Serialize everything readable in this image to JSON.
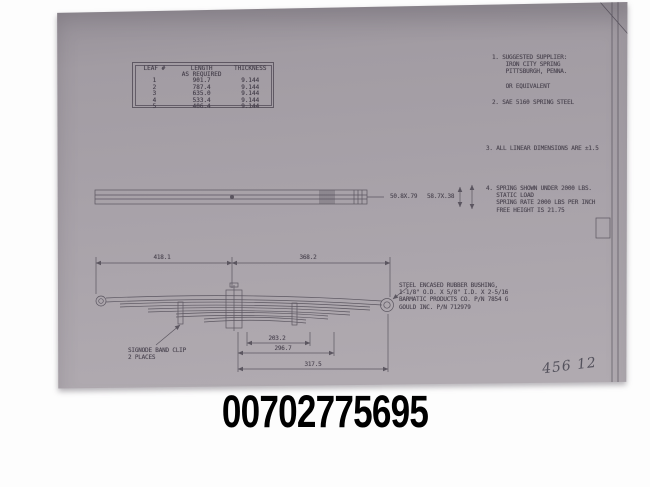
{
  "part_number": "00702775695",
  "colors": {
    "paper": "#a49ea5",
    "paper_shadow": "#938d95",
    "line_ink": "#4a4550",
    "page_background": "#fdfdfd",
    "number_ink": "#000000"
  },
  "drawing": {
    "leaf_table": {
      "headers": [
        "LEAF #",
        "LENGTH\nAS REQUIRED",
        "THICKNESS"
      ],
      "rows": [
        [
          "1",
          "901.7",
          "9.144"
        ],
        [
          "2",
          "787.4",
          "9.144"
        ],
        [
          "3",
          "635.0",
          "9.144"
        ],
        [
          "4",
          "533.4",
          "9.144"
        ],
        [
          "5",
          "406.4",
          "9.144"
        ]
      ]
    },
    "notes": [
      "1. SUGGESTED SUPPLIER:\n    IRON CITY SPRING\n    PITTSBURGH, PENNA.\n\n    OR EQUIVALENT",
      "2. SAE 5160 SPRING STEEL",
      "3. ALL LINEAR DIMENSIONS ARE ±1.5",
      "4. SPRING SHOWN UNDER 2000 LBS.\n   STATIC LOAD\n   SPRING RATE 2000 LBS PER INCH\n   FREE HEIGHT IS 21.75"
    ],
    "dimensions": {
      "section_left": "50.8X.79",
      "section_right": "58.7X.38",
      "overall_left": "418.1",
      "overall_right": "368.2",
      "lower": [
        "203.2",
        "296.7",
        "317.5"
      ]
    },
    "labels": {
      "band_clip": "SIGNODE BAND CLIP\n2 PLACES",
      "bushing_note": "STEEL ENCASED RUBBER BUSHING,\n1-1/8\" O.D. X 5/8\" I.D. X 2-5/16\nBARMATIC PRODUCTS CO. P/N 7854 G\nGOULD INC. P/N 712979"
    },
    "handwriting": "456 12"
  }
}
